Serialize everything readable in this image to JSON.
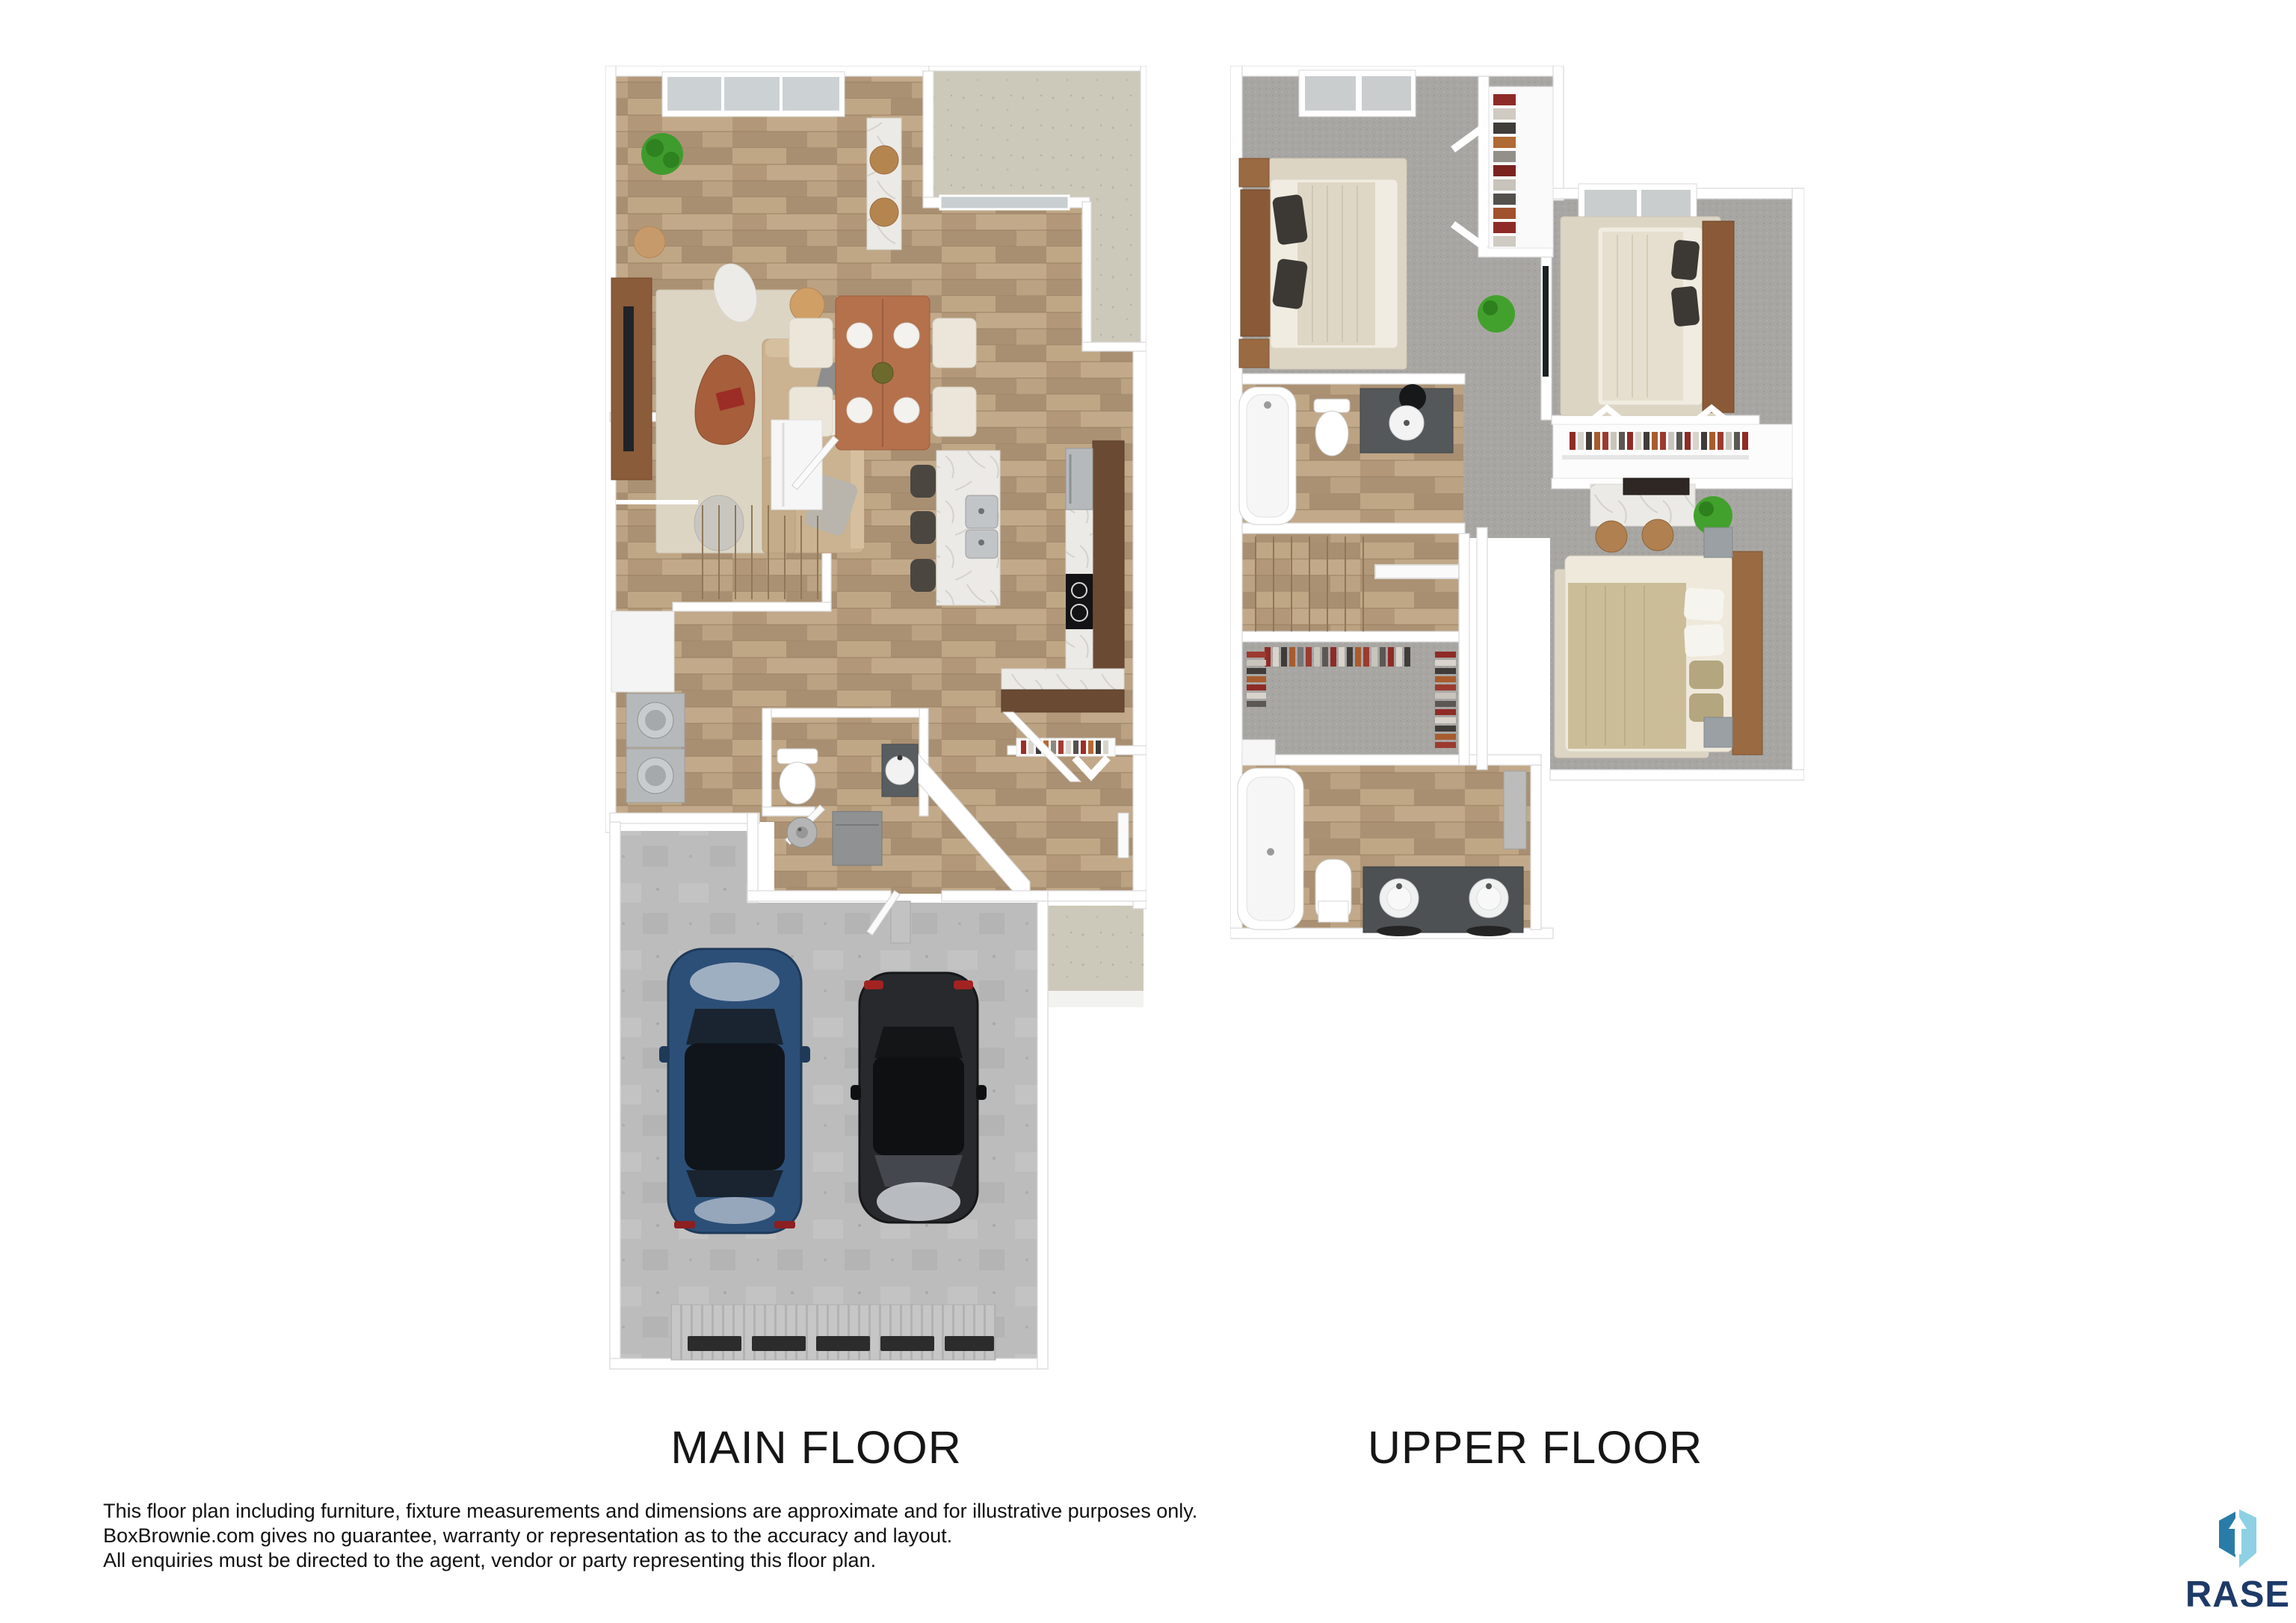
{
  "title_labels": {
    "main": "MAIN FLOOR",
    "upper": "UPPER FLOOR"
  },
  "disclaimer": {
    "lines": [
      "This floor plan including furniture, fixture measurements and dimensions are approximate and for illustrative purposes only.",
      "BoxBrownie.com gives no guarantee, warranty or representation as to the accuracy and layout.",
      "All enquiries must be directed to the agent, vendor or party representing this floor plan."
    ]
  },
  "logo": {
    "text": "RASE",
    "icon": "rase-box-arrow-icon",
    "colors": {
      "left_face": "#2a7ca8",
      "right_face": "#8ed1e4",
      "text_navy": "#1d3a68"
    }
  },
  "palette": {
    "background": "#ffffff",
    "wood_floor": "#b49b7c",
    "carpet_gray": "#a8a6a3",
    "concrete_gray": "#bcbcbc",
    "porch_beige": "#cdc9ba",
    "wall_white": "#ffffff",
    "counter_dark_wood": "#6b4a34",
    "marble": "#eceae6",
    "label_text": "#161616"
  }
}
